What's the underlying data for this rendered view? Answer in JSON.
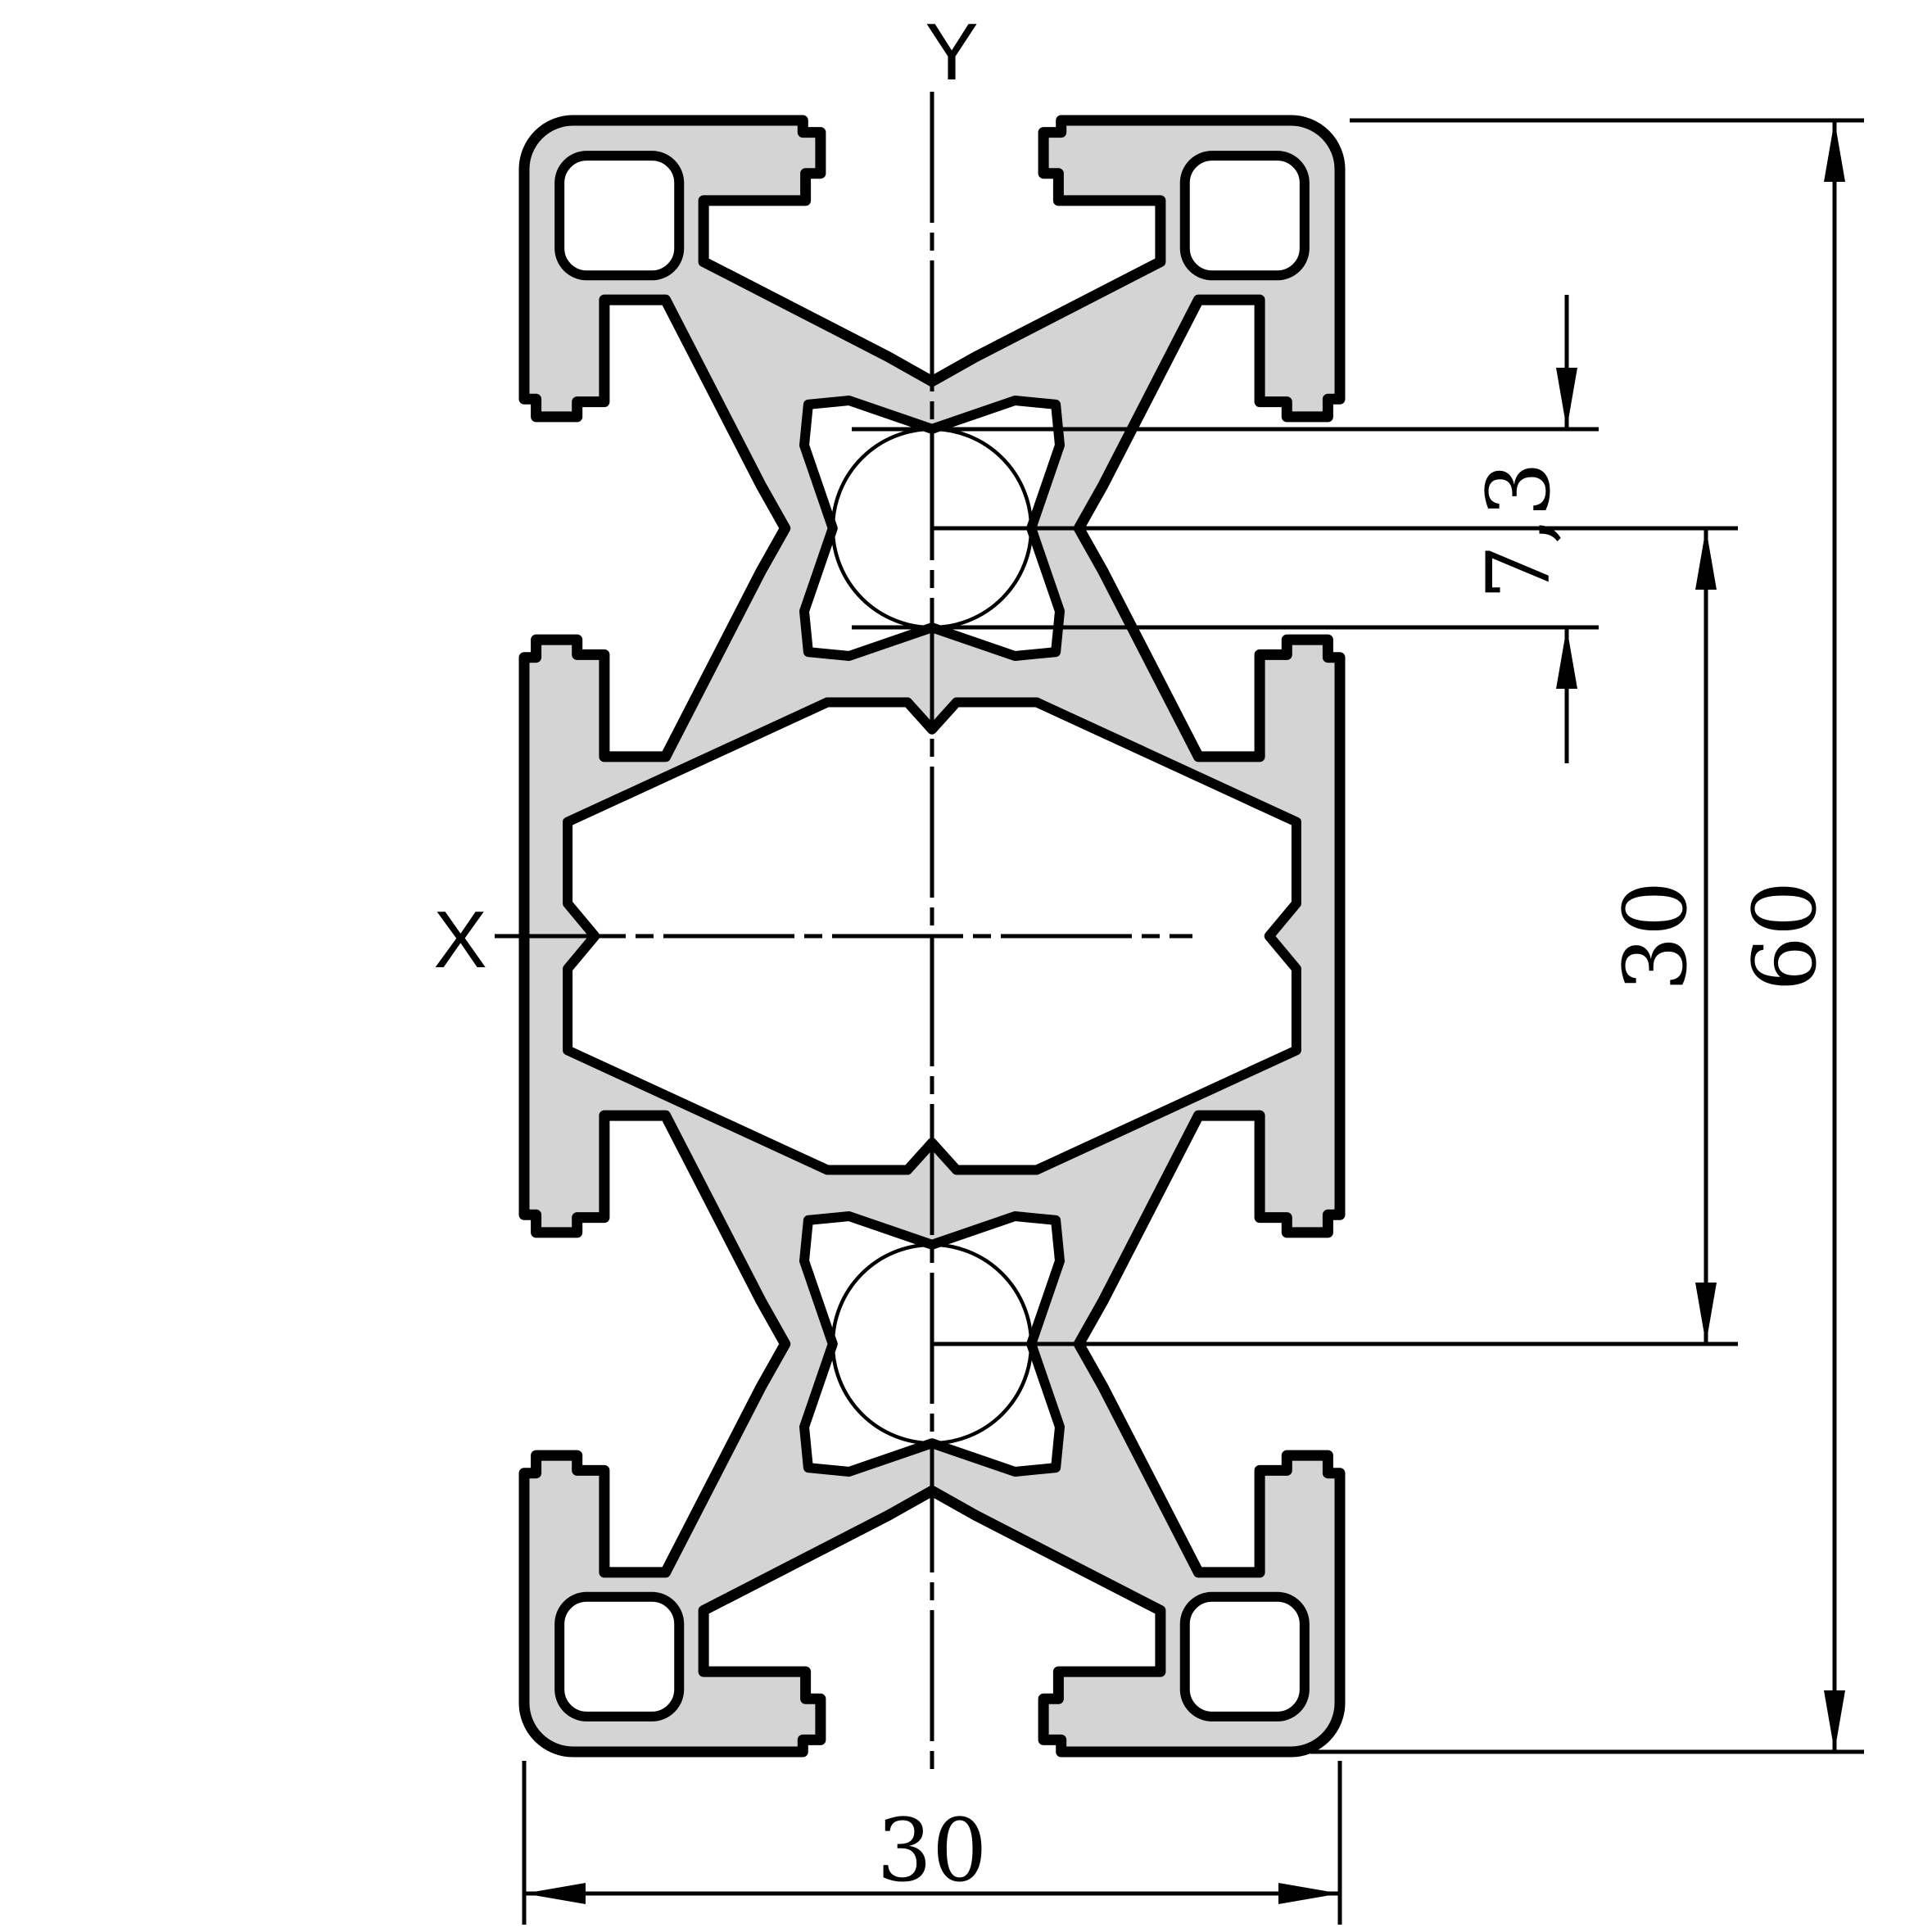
{
  "drawing": {
    "type": "technical cross-section drawing",
    "subject": "aluminum T-slot extrusion profile"
  },
  "axes": {
    "x_label": "X",
    "y_label": "Y"
  },
  "dimensions": {
    "core_diameter": "7,3",
    "slot_pitch_vertical": "30",
    "profile_height": "60",
    "profile_width_bottom": "30"
  },
  "colors": {
    "profile_fill": "#d4d4d4",
    "line": "#000000",
    "background": "#ffffff"
  }
}
